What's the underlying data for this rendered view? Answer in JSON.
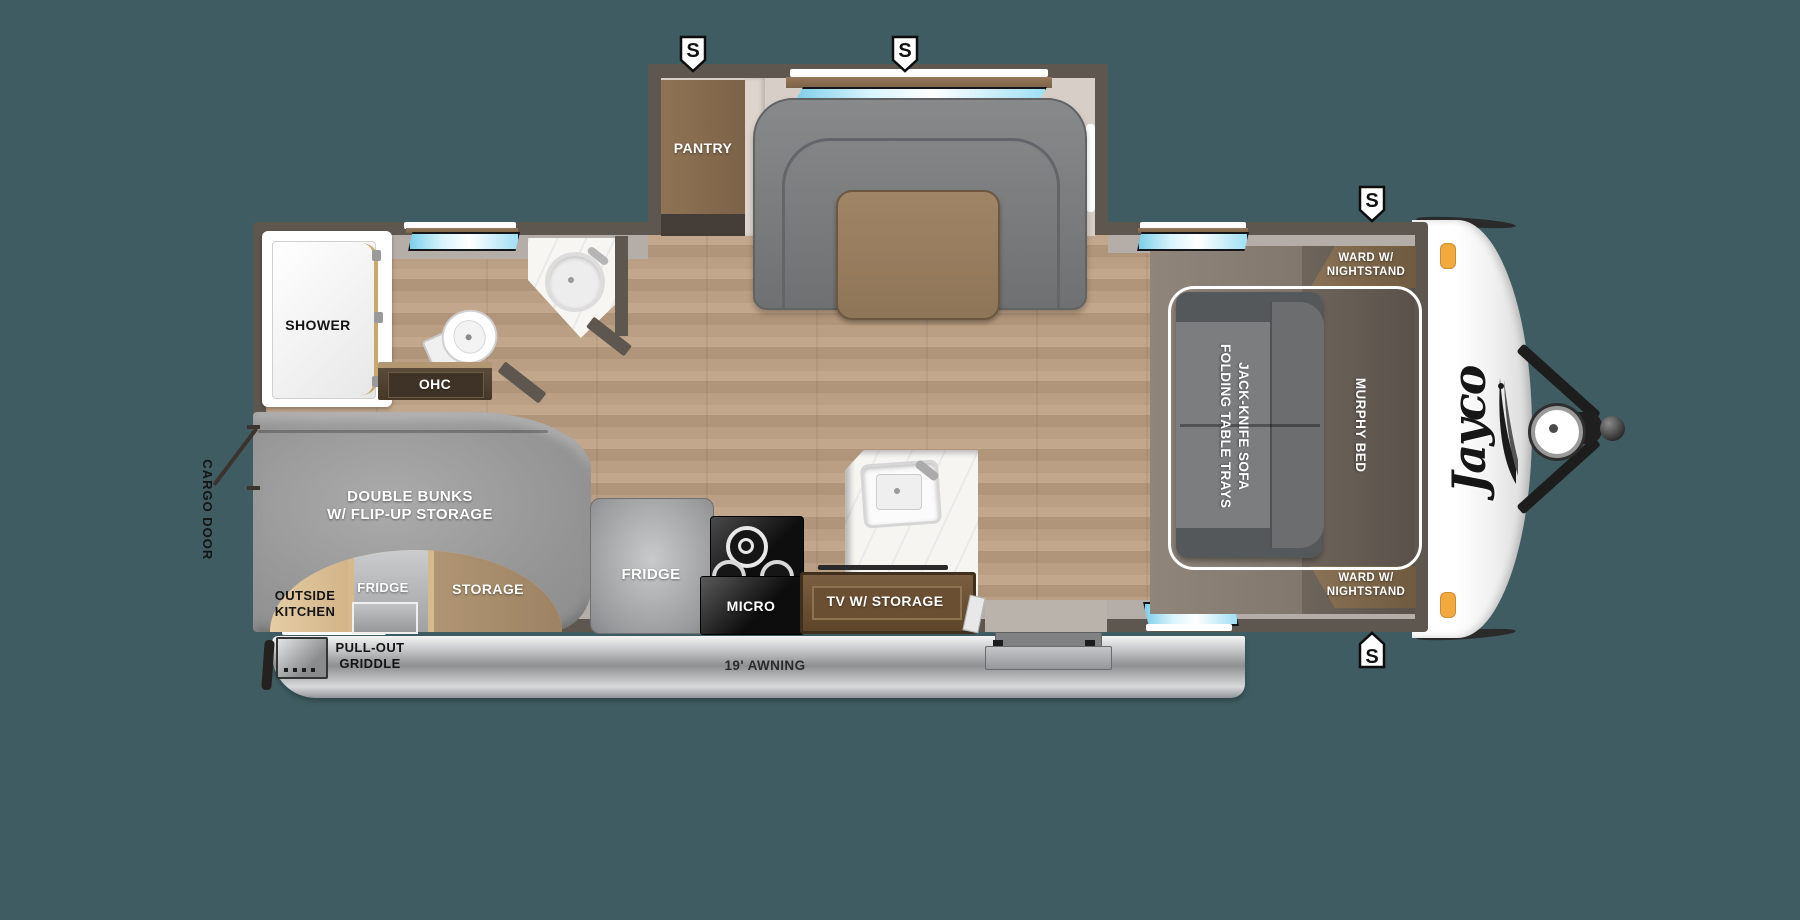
{
  "background_color": "#3E5C61",
  "floorplan": {
    "brand_logo": "Jayco",
    "speaker_label": "S",
    "labels": {
      "pantry": "PANTRY",
      "shower": "SHOWER",
      "ohc": "OHC",
      "cargo_door": "CARGO DOOR",
      "double_bunks": [
        "DOUBLE BUNKS",
        "W/ FLIP-UP STORAGE"
      ],
      "outside_kitchen": [
        "OUTSIDE",
        "KITCHEN"
      ],
      "outside_kitchen_fridge": "FRIDGE",
      "storage": "STORAGE",
      "kitchen_fridge": "FRIDGE",
      "micro": "MICRO",
      "tv": "TV W/ STORAGE",
      "griddle": [
        "PULL-OUT",
        "GRIDDLE"
      ],
      "awning": "19' AWNING",
      "sofa": [
        "JACK-KNIFE SOFA",
        "FOLDING TABLE TRAYS"
      ],
      "murphy_bed": "MURPHY BED",
      "ward": [
        "WARD W/",
        "NIGHTSTAND"
      ]
    },
    "colors": {
      "background": "#3E5C61",
      "wall": "#5E5750",
      "floor_wood": "#B79B80",
      "window_glass": "#9FE0F4",
      "slide_interior": "#D7CFC7",
      "bunk_gray": "#9C9C9C",
      "accent_tan": "#DCC195",
      "storage_wood": "#A98F6F",
      "awning_silver": "#C7C8CA",
      "clearance_light": "#F2A93F"
    }
  }
}
